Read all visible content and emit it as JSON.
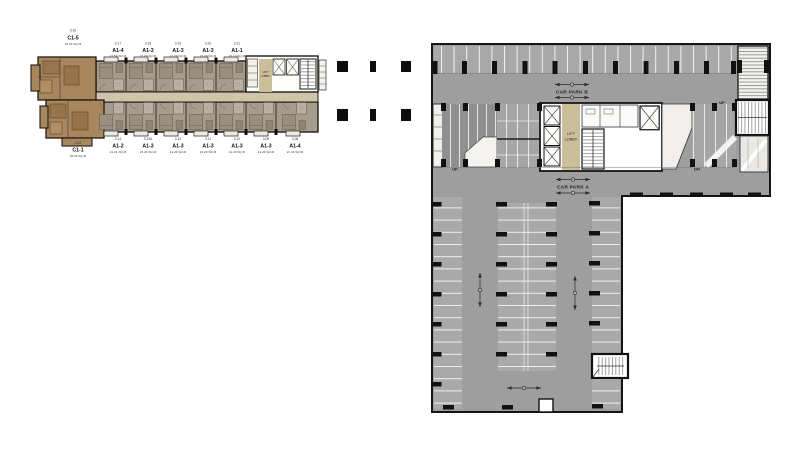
{
  "left_plan": {
    "top_units": [
      {
        "no": "3-16",
        "type": "C1-5",
        "area": "45.54 SQ.M"
      },
      {
        "no": "3-17",
        "type": "A1-4",
        "area": "21.59 SQ.M"
      },
      {
        "no": "3-18",
        "type": "A1-3",
        "area": "21.29 SQ.M"
      },
      {
        "no": "3-19",
        "type": "A1-3",
        "area": "21.29 SQ.M"
      },
      {
        "no": "3-20",
        "type": "A1-3",
        "area": "21.29 SQ.M"
      },
      {
        "no": "3-21",
        "type": "A1-1",
        "area": "21.19 SQ.M"
      }
    ],
    "bottom_units": [
      {
        "no": "3-15",
        "type": "C1-1",
        "area": "45.22 SQ.M"
      },
      {
        "no": "3-14",
        "type": "A1-2",
        "area": "21.21 SQ.M"
      },
      {
        "no": "3-13A",
        "type": "A1-3",
        "area": "21.29 SQ.M"
      },
      {
        "no": "3-12",
        "type": "A1-3",
        "area": "21.29 SQ.M"
      },
      {
        "no": "3-11",
        "type": "A1-3",
        "area": "21.29 SQ.M"
      },
      {
        "no": "3-10",
        "type": "A1-3",
        "area": "21.29 SQ.M"
      },
      {
        "no": "3-09",
        "type": "A1-3",
        "area": "21.29 SQ.M"
      },
      {
        "no": "3-08",
        "type": "A1-4",
        "area": "21.42 SQ.M"
      }
    ],
    "core": {
      "lift_lobby": [
        "LIFT",
        "LOBBY"
      ]
    }
  },
  "right_plan": {
    "zones": {
      "car_park_b": "CAR PARK B",
      "car_park_a": "CAR PARK A"
    },
    "core": {
      "lift_lobby": [
        "LIFT",
        "LOBBY"
      ]
    },
    "labels": {
      "up_left": "UP",
      "dn_right": "DN",
      "up_ramp": "UP"
    }
  },
  "colors": {
    "unit_fill": "#a59c8d",
    "end_unit_fill": "#a8865e",
    "corridor_fill": "#cfc5ab",
    "lift_lobby_fill": "#cbbe9b",
    "carpark_gray": "#9e9e9e",
    "line_black": "#151515"
  }
}
